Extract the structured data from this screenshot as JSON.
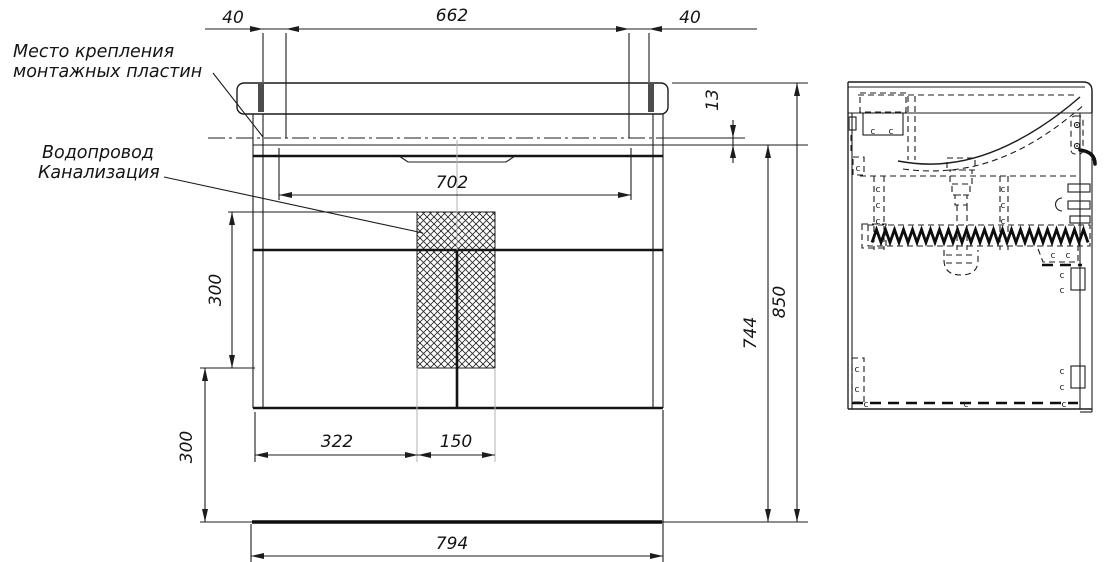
{
  "labels": {
    "mounting_plates_line1": "Место крепления",
    "mounting_plates_line2": "монтажных пластин",
    "plumbing_line1": "Водопровод",
    "plumbing_line2": "Канализация"
  },
  "dimensions": {
    "left_offset": "40",
    "mounting_span": "662",
    "right_offset": "40",
    "apron_height": "13",
    "inner_width": "702",
    "plumbing_zone_height": "300",
    "bottom_clearance": "300",
    "door_offset": "322",
    "plumbing_zone_width": "150",
    "carcass_height": "744",
    "overall_height": "850",
    "overall_width": "794"
  },
  "screw_marks": {
    "glyph": "c",
    "positions": [
      [
        873,
        134
      ],
      [
        891,
        134
      ],
      [
        858,
        171
      ],
      [
        878,
        192
      ],
      [
        878,
        208
      ],
      [
        878,
        224
      ],
      [
        1003,
        192
      ],
      [
        1003,
        208
      ],
      [
        1003,
        224
      ],
      [
        1053,
        258
      ],
      [
        1068,
        258
      ],
      [
        1062,
        278
      ],
      [
        1062,
        293
      ],
      [
        857,
        372
      ],
      [
        857,
        392
      ],
      [
        1062,
        374
      ],
      [
        1062,
        390
      ],
      [
        866,
        407
      ],
      [
        966,
        407
      ],
      [
        1064,
        407
      ]
    ]
  },
  "colors": {
    "line": "#1c1c1c",
    "gray": "#b3b3b3",
    "background": "#ffffff"
  }
}
